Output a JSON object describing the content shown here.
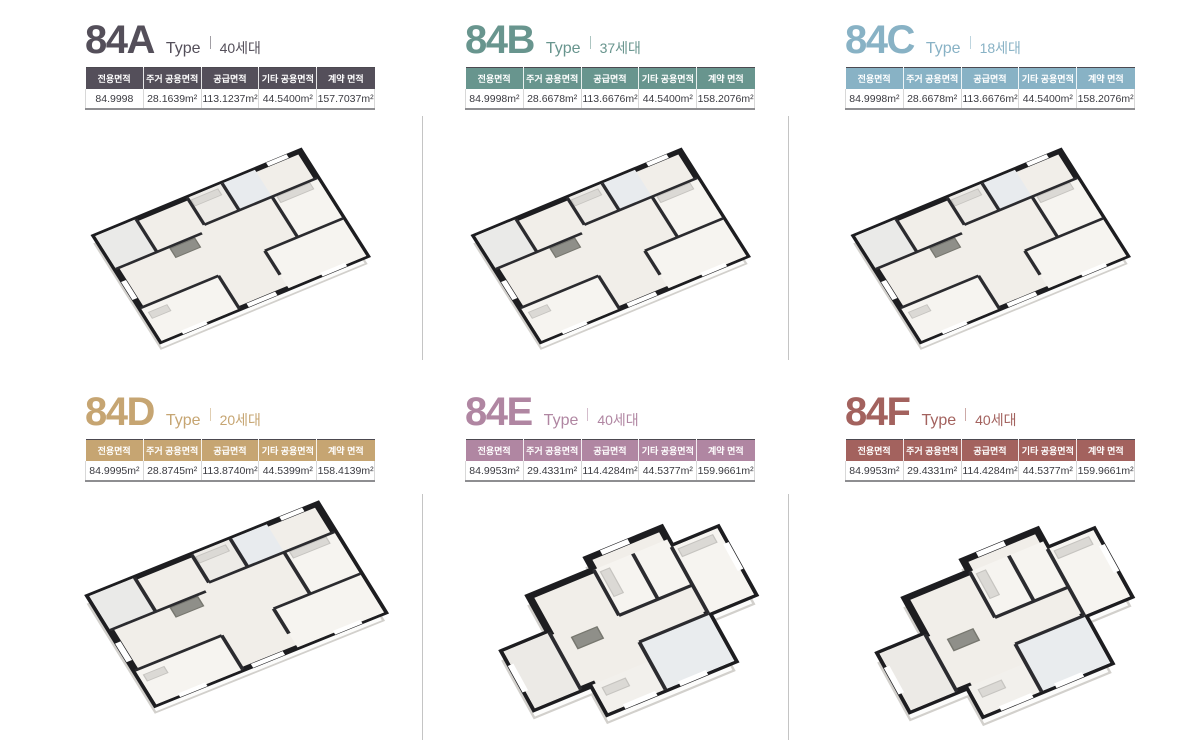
{
  "page": {
    "background_color": "#ffffff",
    "divider_color": "#c4c4c4"
  },
  "units": [
    {
      "id": "84A",
      "name": "84A",
      "type_label": "Type",
      "households": "40세대",
      "theme_color": "#544f5a",
      "plan_description": "isometric-3d-floorplan",
      "table": {
        "headers": [
          "전용면적",
          "주거 공용면적",
          "공급면적",
          "기타 공용면적",
          "계약 면적"
        ],
        "values": [
          "84.9998",
          "28.1639m²",
          "113.1237m²",
          "44.5400m²",
          "157.7037m²"
        ]
      }
    },
    {
      "id": "84B",
      "name": "84B",
      "type_label": "Type",
      "households": "37세대",
      "theme_color": "#68958e",
      "plan_description": "isometric-3d-floorplan",
      "table": {
        "headers": [
          "전용면적",
          "주거 공용면적",
          "공급면적",
          "기타 공용면적",
          "계약 면적"
        ],
        "values": [
          "84.9998m²",
          "28.6678m²",
          "113.6676m²",
          "44.5400m²",
          "158.2076m²"
        ]
      }
    },
    {
      "id": "84C",
      "name": "84C",
      "type_label": "Type",
      "households": "18세대",
      "theme_color": "#88b2c5",
      "plan_description": "isometric-3d-floorplan",
      "table": {
        "headers": [
          "전용면적",
          "주거 공용면적",
          "공급면적",
          "기타 공용면적",
          "계약 면적"
        ],
        "values": [
          "84.9998m²",
          "28.6678m²",
          "113.6676m²",
          "44.5400m²",
          "158.2076m²"
        ]
      }
    },
    {
      "id": "84D",
      "name": "84D",
      "type_label": "Type",
      "households": "20세대",
      "theme_color": "#c6a572",
      "plan_description": "isometric-3d-floorplan",
      "table": {
        "headers": [
          "전용면적",
          "주거 공용면적",
          "공급면적",
          "기타 공용면적",
          "계약 면적"
        ],
        "values": [
          "84.9995m²",
          "28.8745m²",
          "113.8740m²",
          "44.5399m²",
          "158.4139m²"
        ]
      }
    },
    {
      "id": "84E",
      "name": "84E",
      "type_label": "Type",
      "households": "40세대",
      "theme_color": "#b086a2",
      "plan_description": "isometric-3d-floorplan",
      "table": {
        "headers": [
          "전용면적",
          "주거 공용면적",
          "공급면적",
          "기타 공용면적",
          "계약 면적"
        ],
        "values": [
          "84.9953m²",
          "29.4331m²",
          "114.4284m²",
          "44.5377m²",
          "159.9661m²"
        ]
      }
    },
    {
      "id": "84F",
      "name": "84F",
      "type_label": "Type",
      "households": "40세대",
      "theme_color": "#a3625e",
      "plan_description": "isometric-3d-floorplan",
      "table": {
        "headers": [
          "전용면적",
          "주거 공용면적",
          "공급면적",
          "기타 공용면적",
          "계약 면적"
        ],
        "values": [
          "84.9953m²",
          "29.4331m²",
          "114.4284m²",
          "44.5377m²",
          "159.9661m²"
        ]
      }
    }
  ]
}
